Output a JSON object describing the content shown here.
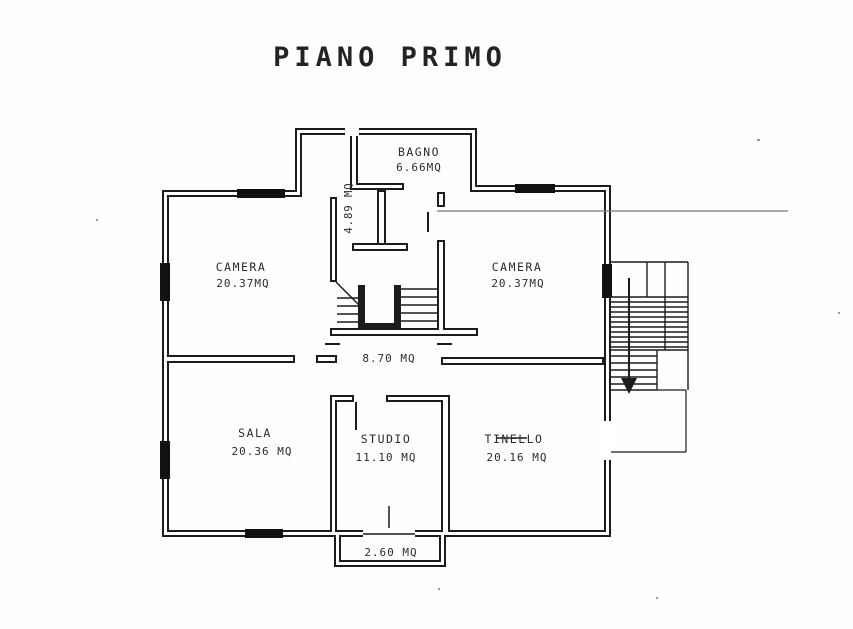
{
  "title": "PIANO PRIMO",
  "rooms": {
    "bagno": {
      "name": "BAGNO",
      "area": "6.66MQ"
    },
    "corridoio": {
      "area": "4.89 MQ"
    },
    "camera_left": {
      "name": "CAMERA",
      "area": "20.37MQ"
    },
    "camera_right": {
      "name": "CAMERA",
      "area": "20.37MQ"
    },
    "hall": {
      "area": "8.70 MQ"
    },
    "sala": {
      "name": "SALA",
      "area": "20.36 MQ"
    },
    "studio": {
      "name": "STUDIO",
      "area": "11.10 MQ"
    },
    "tinello": {
      "name": "TINELLO",
      "area": "20.16 MQ"
    },
    "balcone": {
      "area": "2.60 MQ"
    }
  },
  "colors": {
    "ink": "#1c1c1c",
    "paper": "#ffffff",
    "faint": "#8a8a8a"
  }
}
